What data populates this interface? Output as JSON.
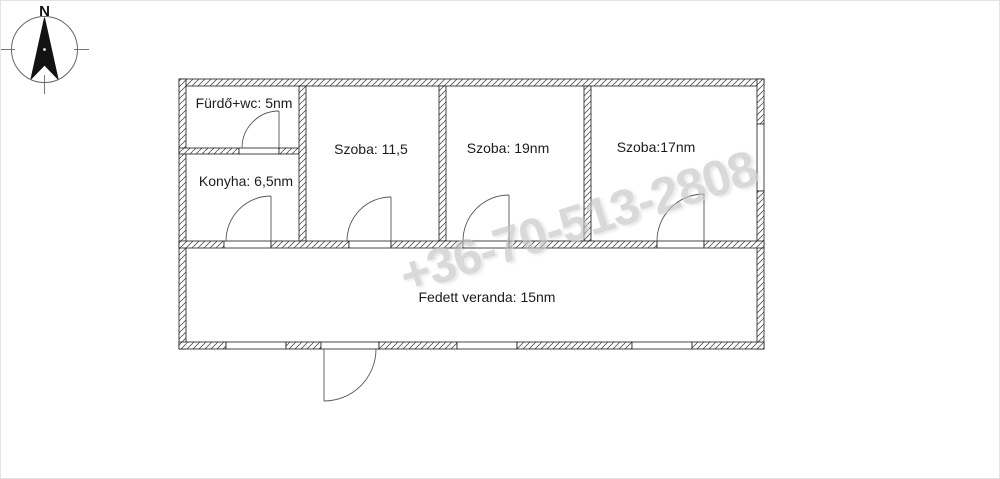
{
  "compass": {
    "north_label": "N"
  },
  "floor_plan": {
    "rooms": [
      {
        "name": "bathroom",
        "label": "Fürdő+wc: 5nm"
      },
      {
        "name": "kitchen",
        "label": "Konyha: 6,5nm"
      },
      {
        "name": "room-1",
        "label": "Szoba: 11,5"
      },
      {
        "name": "room-2",
        "label": "Szoba: 19nm"
      },
      {
        "name": "room-3",
        "label": "Szoba:17nm"
      },
      {
        "name": "veranda",
        "label": "Fedett veranda: 15nm"
      }
    ],
    "wall_color": "#1a1a1a",
    "hatch_color": "#555555"
  },
  "watermark": {
    "text": "+36-70-513-2808",
    "color": "#c2c2c2"
  }
}
